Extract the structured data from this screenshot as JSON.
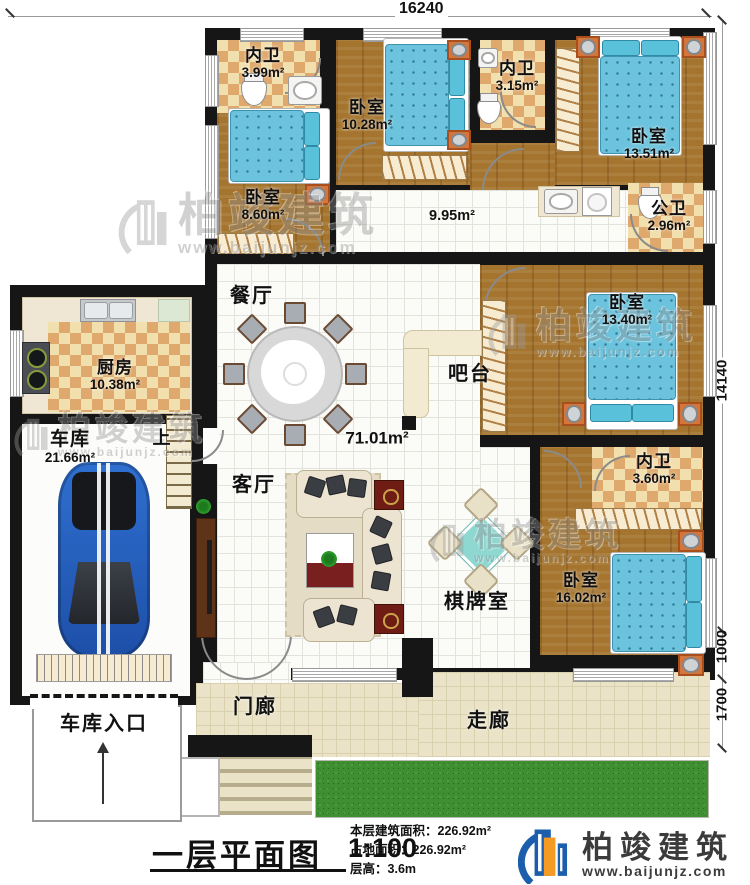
{
  "dimensions": {
    "top": "16240",
    "right_main": "14140",
    "right_mid": "1000",
    "right_bottom": "1700"
  },
  "rooms": {
    "bath_top_left": {
      "name": "内卫",
      "area": "3.99m²"
    },
    "bed_top_mid": {
      "name": "卧室",
      "area": "10.28m²"
    },
    "bath_top_mid": {
      "name": "内卫",
      "area": "3.15m²"
    },
    "bed_top_right": {
      "name": "卧室",
      "area": "13.51m²"
    },
    "bed_left": {
      "name": "卧室",
      "area": "8.60m²"
    },
    "corridor_area": "9.95m²",
    "bath_public": {
      "name": "公卫",
      "area": "2.96m²"
    },
    "dining": {
      "name": "餐厅"
    },
    "kitchen": {
      "name": "厨房",
      "area": "10.38m²"
    },
    "bed_right": {
      "name": "卧室",
      "area": "13.40m²"
    },
    "bar": {
      "name": "吧台"
    },
    "garage": {
      "name": "车库",
      "area": "21.66m²"
    },
    "stairs_up": "上",
    "living_area": "71.01m²",
    "bath_inner_right": {
      "name": "内卫",
      "area": "3.60m²"
    },
    "living": {
      "name": "客厅"
    },
    "game_room": {
      "name": "棋牌室"
    },
    "bed_bottom_right": {
      "name": "卧室",
      "area": "16.02m²"
    },
    "porch": {
      "name": "门廊"
    },
    "veranda": {
      "name": "走廊"
    },
    "garage_entry": {
      "name": "车库入口"
    }
  },
  "title_block": {
    "title": "一层平面图",
    "scale": "1:100",
    "lines": [
      {
        "label": "本层建筑面积：",
        "value": "226.92m²"
      },
      {
        "label": "占地面积：",
        "value": "226.92m²"
      },
      {
        "label": "层高：",
        "value": "3.6m"
      }
    ]
  },
  "brand": {
    "name": "柏竣建筑",
    "site": "www.baijunjz.com"
  },
  "watermark": {
    "name": "柏竣建筑",
    "site": "www.baijunjz.com"
  },
  "colors": {
    "wall": "#161616",
    "wood": "#a5752f",
    "tile_tan": "#dfa96e",
    "bed_blue": "#6cc3dd",
    "grass": "#3d8f2f",
    "brand_blue": "#1b5eab",
    "brand_orange": "#f59a23"
  }
}
